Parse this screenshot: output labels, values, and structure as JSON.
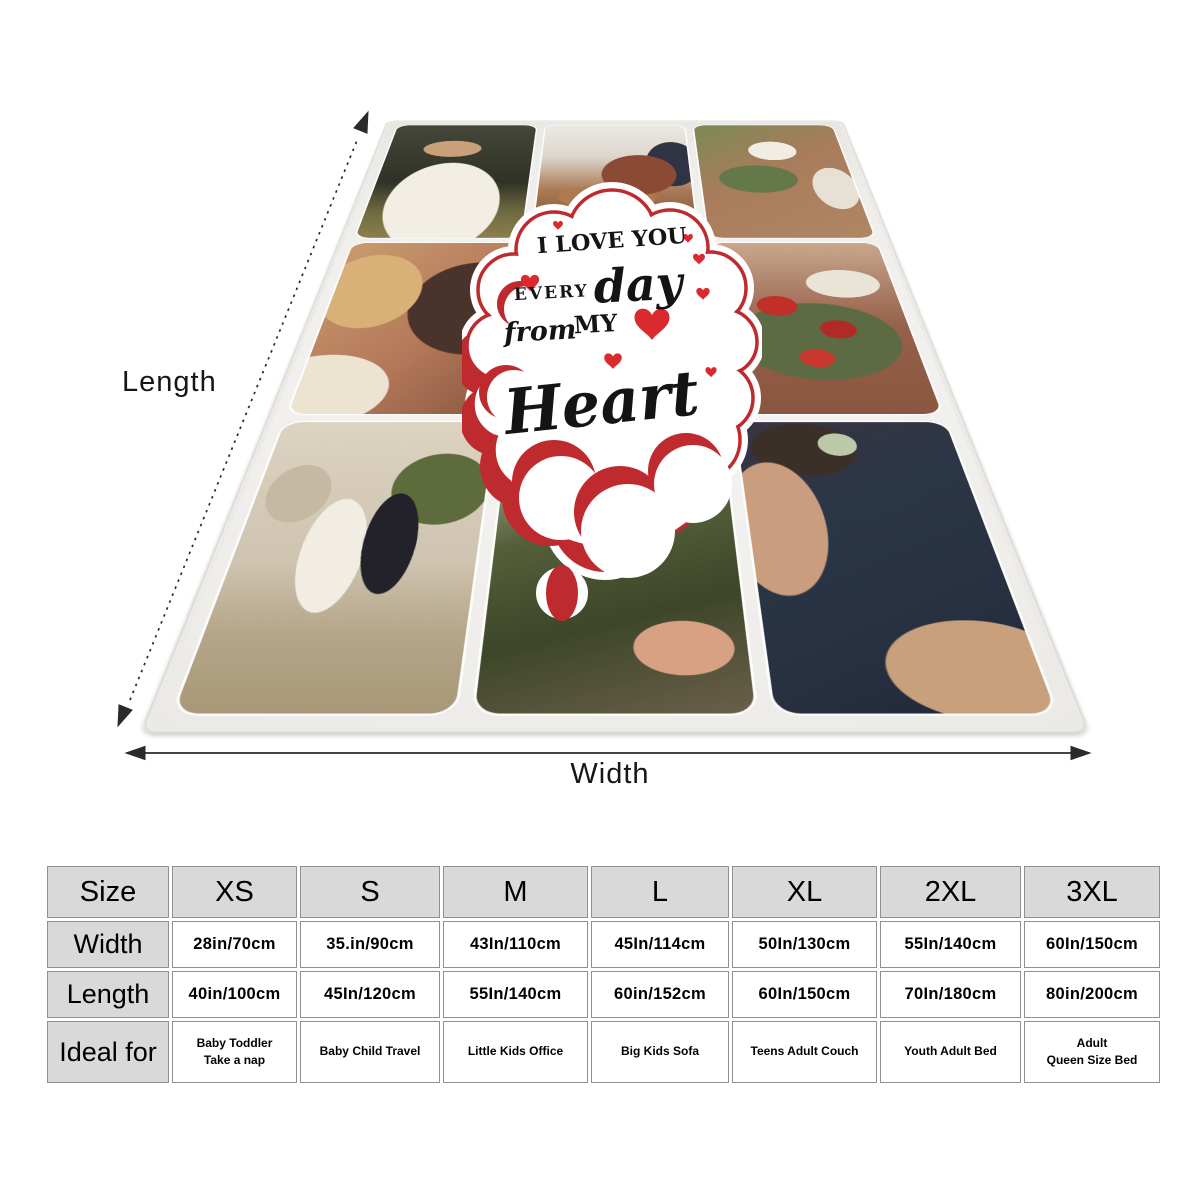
{
  "labels": {
    "length": "Length",
    "width": "Width"
  },
  "cloud": {
    "line1": "I LOVE YOU",
    "line2_prefix": "EVERY",
    "line2_script": "day",
    "line3_script": "from",
    "line3_caps": "MY",
    "line4": "Heart"
  },
  "blanket": {
    "photos": {
      "top_left": "bride-white-gown-outdoors",
      "top_middle": "couple-embracing-indoors",
      "top_right": "bride-holding-white-bouquet",
      "middle_left": "kissing-couple-closeup",
      "middle_right": "red-lily-bouquet",
      "bottom_left": "bride-groom-walking-away",
      "bottom_middle": "white-flowers-closeup",
      "bottom_right": "couple-navy-attire-succulent"
    }
  },
  "size_chart": {
    "header": [
      "Size",
      "XS",
      "S",
      "M",
      "L",
      "XL",
      "2XL",
      "3XL"
    ],
    "row_labels": [
      "Width",
      "Length",
      "Ideal for"
    ],
    "width_values": [
      "28in/70cm",
      "35.in/90cm",
      "43In/110cm",
      "45In/114cm",
      "50In/130cm",
      "55In/140cm",
      "60In/150cm"
    ],
    "length_values": [
      "40in/100cm",
      "45In/120cm",
      "55In/140cm",
      "60in/152cm",
      "60In/150cm",
      "70In/180cm",
      "80in/200cm"
    ],
    "ideal_values": [
      [
        "Baby Toddler",
        "Take a nap"
      ],
      [
        "Baby Child Travel"
      ],
      [
        "Little Kids Office"
      ],
      [
        "Big Kids Sofa"
      ],
      [
        "Teens Adult Couch"
      ],
      [
        "Youth Adult Bed"
      ],
      [
        "Adult",
        "Queen Size Bed"
      ]
    ]
  },
  "colors": {
    "cloud_red": "#bf2a2e",
    "heart_red": "#da2a2f",
    "table_header_bg": "#d9d9d9",
    "table_border": "#8f8f8f"
  }
}
